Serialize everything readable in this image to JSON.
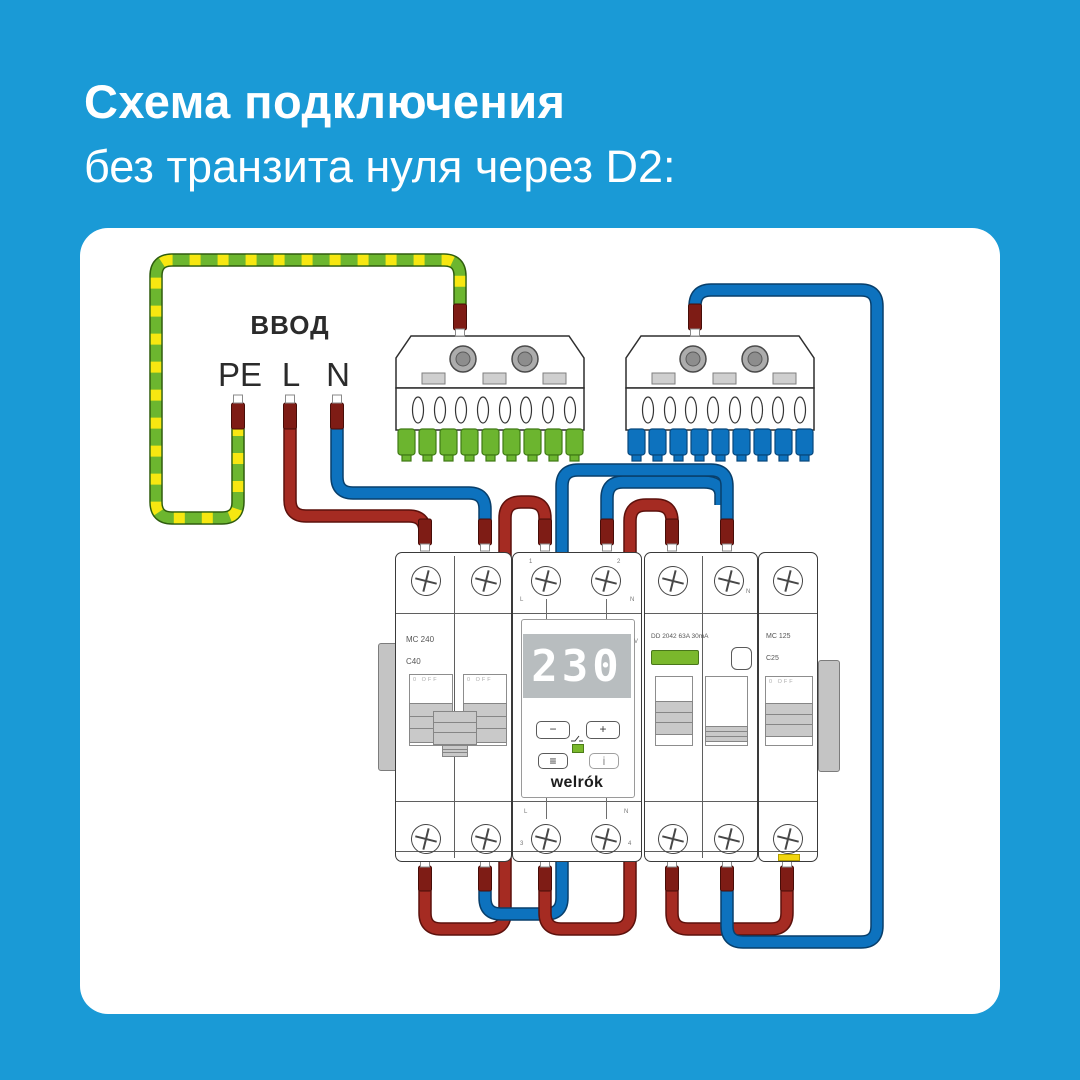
{
  "title": {
    "line1": "Схема подключения",
    "line2": "без транзита нуля через D2:"
  },
  "diagram": {
    "input_label": "ВВОД",
    "input_terminals": {
      "pe": "PE",
      "line": "L",
      "neutral": "N"
    },
    "wire_colors": {
      "line_red": "#a52b22",
      "neutral_blue": "#0d72be",
      "earth_green": "#6cb62f",
      "earth_stripe_yellow": "#f7e711"
    },
    "pe_bus": {
      "teeth_color": "#6cb52f"
    },
    "n_bus": {
      "teeth_color": "#0d72be"
    },
    "devices": {
      "input_breaker": {
        "model": "MC 240",
        "rating": "C40",
        "switch_marking": "0 OFF"
      },
      "relay": {
        "display_value": "230",
        "display_unit": "V",
        "terminals": {
          "t1": "1",
          "t2": "2",
          "t3": "3",
          "t4": "4",
          "line": "L",
          "neutral": "N"
        },
        "buttons": {
          "minus": "−",
          "plus": "+",
          "menu": "≡",
          "info": "i"
        },
        "brand": "welrók",
        "led_color": "#7ab82c"
      },
      "rcd": {
        "model": "DD 2042 63A 30mA",
        "neutral_marking": "N"
      },
      "group_breaker": {
        "model": "MC 125",
        "rating": "C25",
        "switch_marking": "0 OFF"
      }
    }
  }
}
